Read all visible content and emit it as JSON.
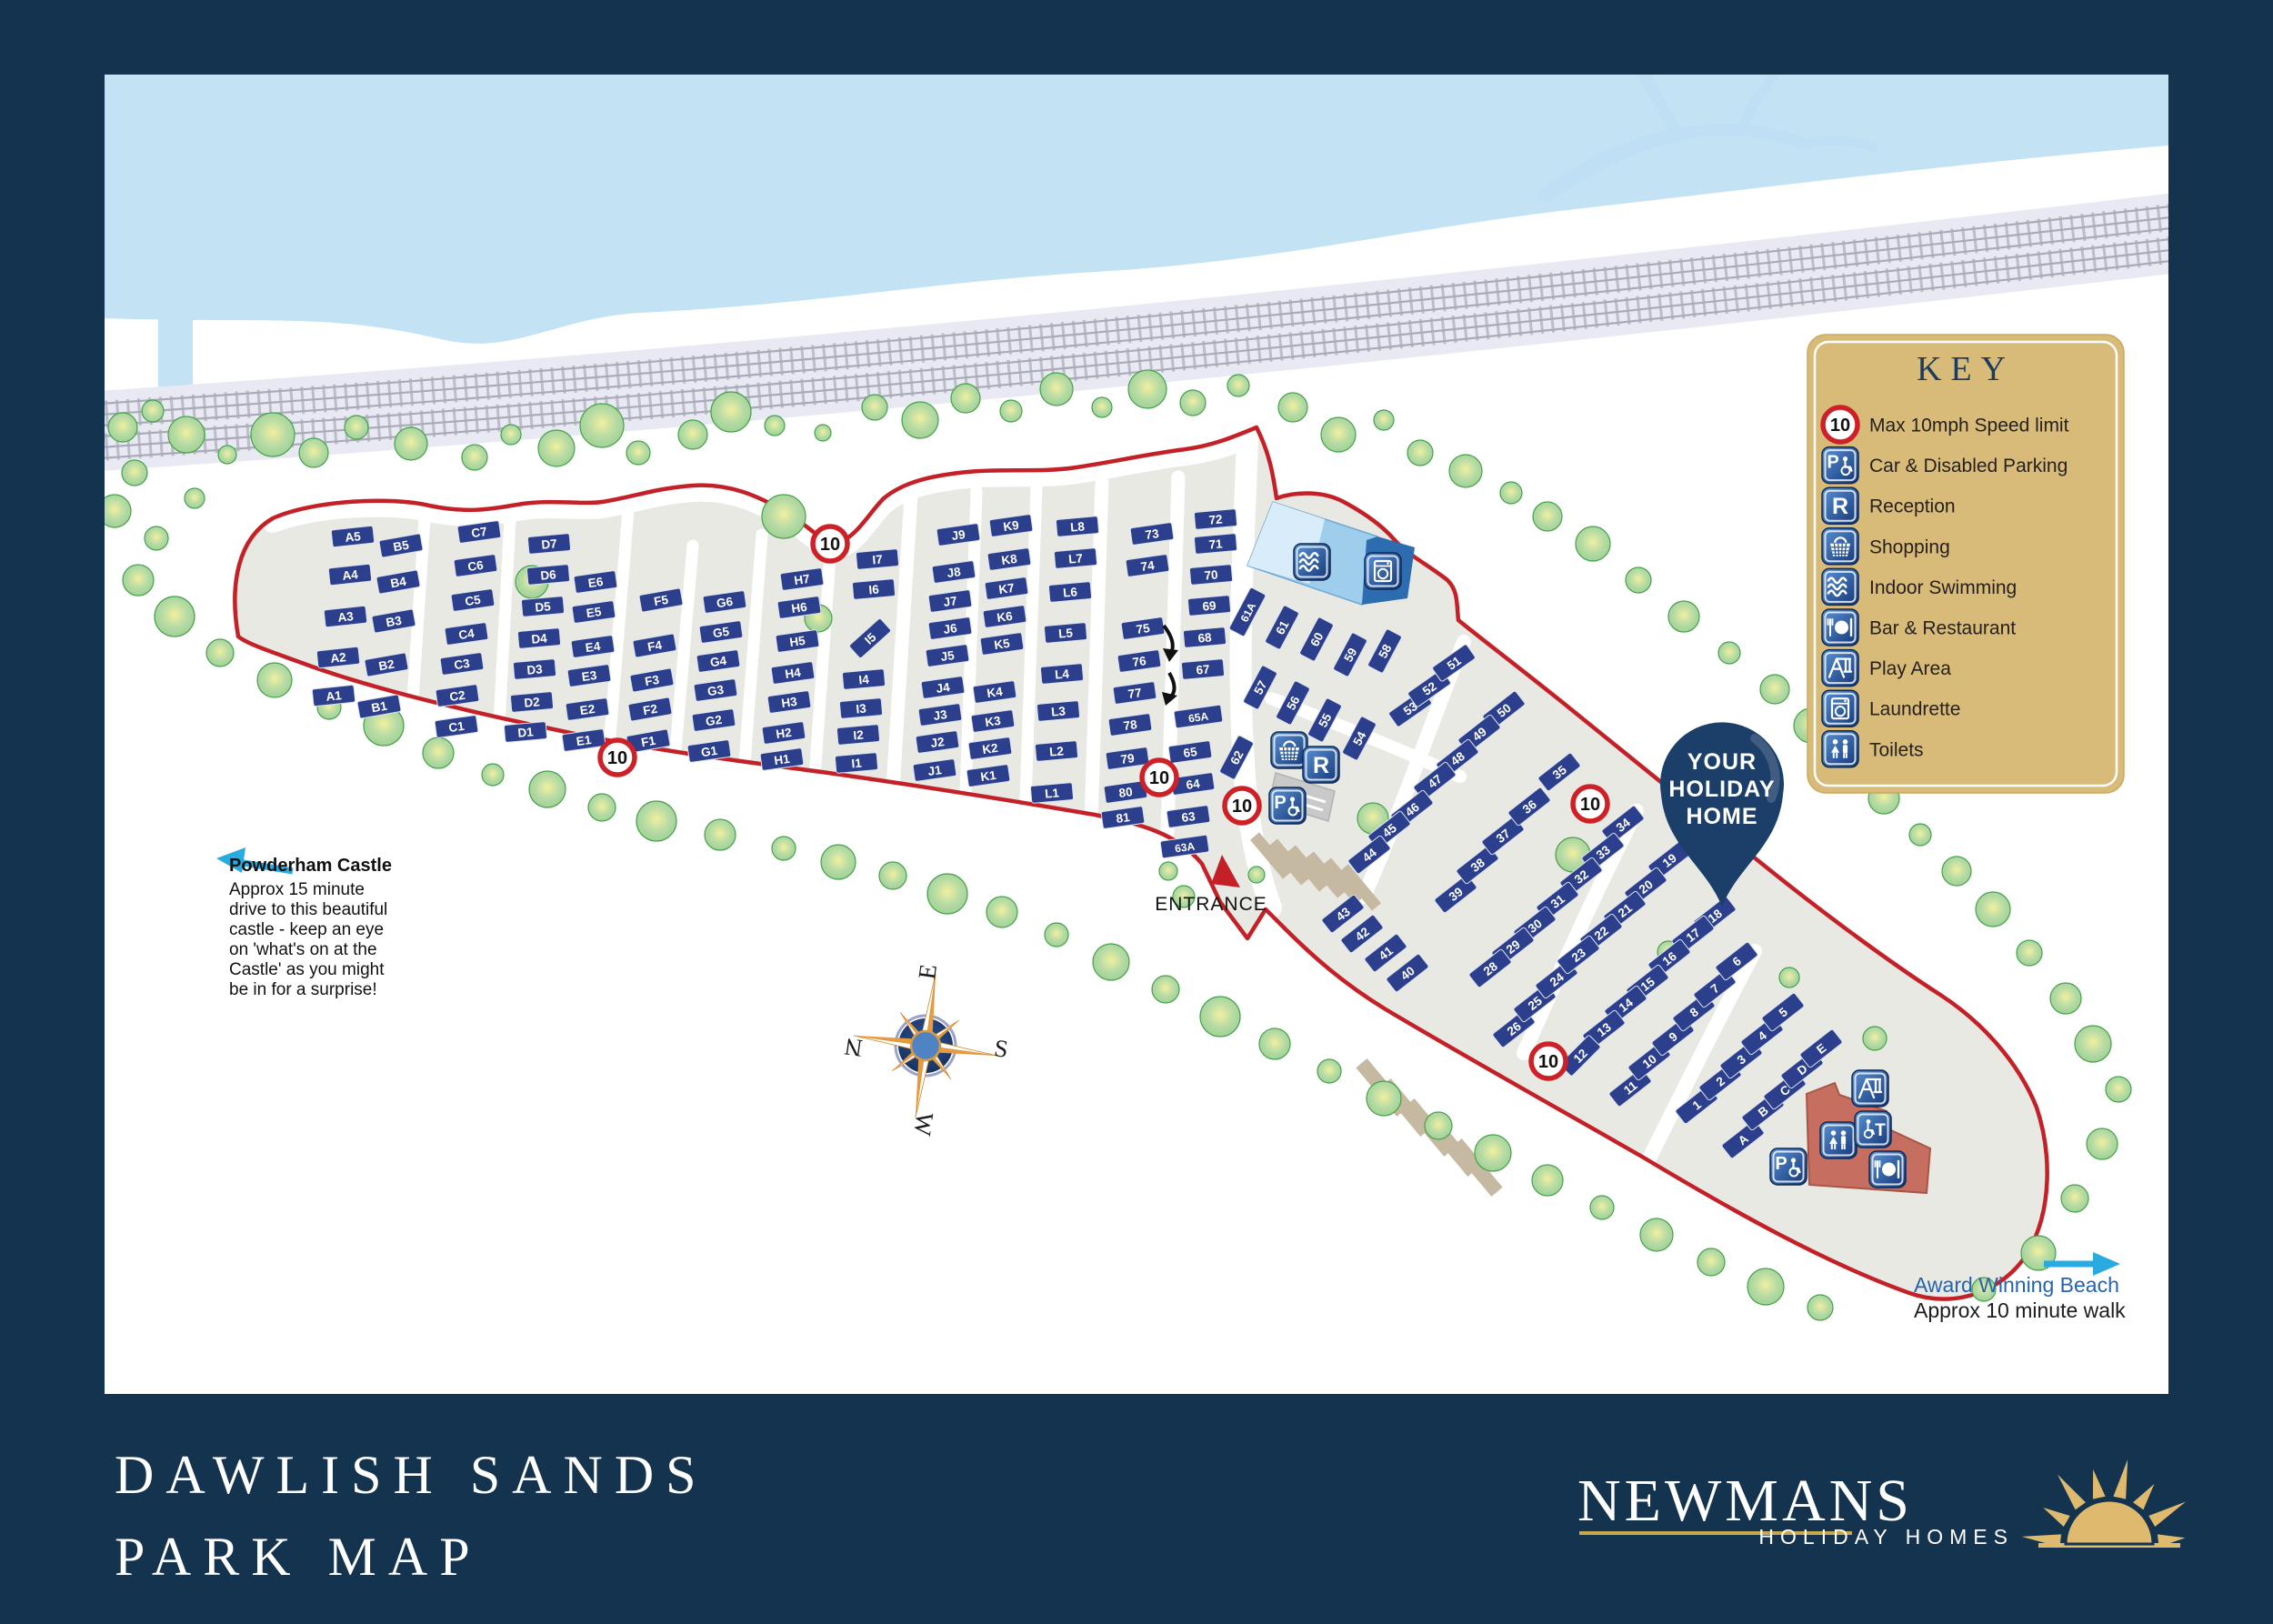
{
  "title": {
    "line1": "DAWLISH SANDS",
    "line2": "PARK MAP"
  },
  "brand": {
    "name": "NEWMANS",
    "tagline": "HOLIDAY HOMES"
  },
  "colors": {
    "border_navy": "#14334f",
    "plot_navy": "#2c3f8d",
    "boundary_red": "#c32127",
    "land_grey": "#e9e9e4",
    "water_blue": "#c3e2f4",
    "tree_green": "#aed7a2",
    "legend_gold": "#d8bb78",
    "icon_blue": "#1e4d9b",
    "pin_navy": "#1c3f69",
    "logo_gold": "#d9b96a",
    "arrow_blue": "#29abe2"
  },
  "legend": {
    "title": "KEY",
    "items": [
      {
        "type": "speed",
        "label": "Max 10mph Speed limit"
      },
      {
        "type": "parking",
        "label": "Car & Disabled Parking"
      },
      {
        "type": "reception",
        "label": "Reception"
      },
      {
        "type": "shopping",
        "label": "Shopping"
      },
      {
        "type": "swim",
        "label": "Indoor Swimming"
      },
      {
        "type": "bar",
        "label": "Bar & Restaurant"
      },
      {
        "type": "play",
        "label": "Play Area"
      },
      {
        "type": "laundrette",
        "label": "Laundrette"
      },
      {
        "type": "toilets",
        "label": "Toilets"
      }
    ]
  },
  "icon_glyphs": {
    "reception": "R",
    "parking": "P",
    "disabled": "T"
  },
  "annotations": {
    "entrance": "ENTRANCE",
    "pin": [
      "YOUR",
      "HOLIDAY",
      "HOME"
    ],
    "compass": {
      "n": "N",
      "e": "E",
      "s": "S",
      "w": "W"
    },
    "powderham": {
      "heading": "Powderham Castle",
      "lines": [
        "Approx 15 minute",
        "drive to this beautiful",
        "castle - keep an eye",
        "on 'what's on at the",
        "Castle' as you might",
        "be in for a surprise!"
      ]
    },
    "beach": {
      "line1": "Award Winning Beach",
      "line2": "Approx 10 minute walk"
    }
  },
  "map": {
    "speed_label": "10",
    "speed_signs": [
      [
        913,
        598
      ],
      [
        679,
        833
      ],
      [
        1275,
        855
      ],
      [
        1366,
        886
      ],
      [
        1749,
        884
      ],
      [
        1703,
        1167
      ]
    ],
    "facility_icons": [
      [
        "swim",
        1443,
        618
      ],
      [
        "laundrette",
        1521,
        628
      ],
      [
        "shopping",
        1418,
        825
      ],
      [
        "reception",
        1453,
        841
      ],
      [
        "parking",
        1416,
        886
      ],
      [
        "parking",
        1967,
        1283
      ],
      [
        "play",
        2057,
        1197
      ],
      [
        "toilets",
        2022,
        1254
      ],
      [
        "disabled",
        2060,
        1242
      ],
      [
        "bar",
        2076,
        1286
      ]
    ],
    "plots": [
      [
        "A5",
        388,
        590,
        -6
      ],
      [
        "A4",
        385,
        632,
        -6
      ],
      [
        "A3",
        380,
        678,
        -6
      ],
      [
        "A2",
        372,
        723,
        -6
      ],
      [
        "A1",
        367,
        765,
        -6
      ],
      [
        "B5",
        441,
        600,
        -10
      ],
      [
        "B4",
        438,
        640,
        -10
      ],
      [
        "B3",
        433,
        683,
        -10
      ],
      [
        "B2",
        425,
        731,
        -10
      ],
      [
        "B1",
        417,
        777,
        -10
      ],
      [
        "C7",
        527,
        585,
        -8
      ],
      [
        "C6",
        523,
        622,
        -8
      ],
      [
        "C5",
        520,
        660,
        -8
      ],
      [
        "C4",
        513,
        697,
        -8
      ],
      [
        "C3",
        508,
        730,
        -8
      ],
      [
        "C2",
        503,
        765,
        -8
      ],
      [
        "C1",
        502,
        799,
        -8
      ],
      [
        "D7",
        604,
        598,
        -5
      ],
      [
        "D6",
        603,
        632,
        -5
      ],
      [
        "D5",
        597,
        667,
        -5
      ],
      [
        "D4",
        593,
        702,
        -5
      ],
      [
        "D3",
        588,
        736,
        -5
      ],
      [
        "D2",
        585,
        772,
        -5
      ],
      [
        "D1",
        578,
        805,
        -5
      ],
      [
        "E6",
        655,
        640,
        -8
      ],
      [
        "E5",
        653,
        673,
        -8
      ],
      [
        "E4",
        652,
        711,
        -8
      ],
      [
        "E3",
        648,
        743,
        -8
      ],
      [
        "E2",
        646,
        780,
        -8
      ],
      [
        "E1",
        642,
        814,
        -8
      ],
      [
        "F5",
        727,
        660,
        -10
      ],
      [
        "F4",
        720,
        710,
        -10
      ],
      [
        "F3",
        717,
        748,
        -10
      ],
      [
        "F2",
        715,
        780,
        -10
      ],
      [
        "F1",
        713,
        815,
        -10
      ],
      [
        "G6",
        797,
        662,
        -8
      ],
      [
        "G5",
        793,
        695,
        -8
      ],
      [
        "G4",
        790,
        727,
        -8
      ],
      [
        "G3",
        787,
        759,
        -8
      ],
      [
        "G2",
        785,
        792,
        -8
      ],
      [
        "G1",
        780,
        826,
        -8
      ],
      [
        "H7",
        882,
        637,
        -8
      ],
      [
        "H6",
        879,
        668,
        -8
      ],
      [
        "H5",
        877,
        705,
        -8
      ],
      [
        "H4",
        872,
        740,
        -8
      ],
      [
        "H3",
        868,
        772,
        -8
      ],
      [
        "H2",
        862,
        806,
        -8
      ],
      [
        "H1",
        860,
        835,
        -8
      ],
      [
        "I7",
        965,
        615,
        -5
      ],
      [
        "I6",
        961,
        648,
        -5
      ],
      [
        "I5",
        957,
        702,
        -42
      ],
      [
        "I4",
        950,
        747,
        -5
      ],
      [
        "I3",
        947,
        779,
        -5
      ],
      [
        "I2",
        944,
        808,
        -5
      ],
      [
        "I1",
        942,
        839,
        -5
      ],
      [
        "J9",
        1054,
        588,
        -8
      ],
      [
        "J8",
        1049,
        629,
        -8
      ],
      [
        "J7",
        1045,
        661,
        -8
      ],
      [
        "J6",
        1045,
        691,
        -8
      ],
      [
        "J5",
        1042,
        721,
        -8
      ],
      [
        "J4",
        1037,
        756,
        -8
      ],
      [
        "J3",
        1034,
        786,
        -8
      ],
      [
        "J2",
        1031,
        816,
        -8
      ],
      [
        "J1",
        1028,
        847,
        -8
      ],
      [
        "K9",
        1112,
        578,
        -8
      ],
      [
        "K8",
        1110,
        615,
        -8
      ],
      [
        "K7",
        1107,
        647,
        -8
      ],
      [
        "K6",
        1105,
        678,
        -8
      ],
      [
        "K5",
        1102,
        708,
        -8
      ],
      [
        "K4",
        1094,
        761,
        -8
      ],
      [
        "K3",
        1092,
        793,
        -8
      ],
      [
        "K2",
        1089,
        823,
        -8
      ],
      [
        "K1",
        1087,
        853,
        -8
      ],
      [
        "L8",
        1185,
        579,
        -5
      ],
      [
        "L7",
        1183,
        614,
        -5
      ],
      [
        "L6",
        1177,
        651,
        -5
      ],
      [
        "L5",
        1172,
        696,
        -5
      ],
      [
        "L4",
        1168,
        741,
        -5
      ],
      [
        "L3",
        1164,
        782,
        -5
      ],
      [
        "L2",
        1162,
        826,
        -5
      ],
      [
        "L1",
        1157,
        872,
        -5
      ],
      [
        "73",
        1267,
        587,
        -8
      ],
      [
        "74",
        1262,
        622,
        -8
      ],
      [
        "75",
        1257,
        691,
        -8
      ],
      [
        "76",
        1253,
        727,
        -8
      ],
      [
        "77",
        1248,
        762,
        -8
      ],
      [
        "78",
        1243,
        797,
        -8
      ],
      [
        "79",
        1240,
        834,
        -8
      ],
      [
        "80",
        1238,
        871,
        -8
      ],
      [
        "81",
        1235,
        899,
        -8
      ],
      [
        "72",
        1337,
        571,
        -5
      ],
      [
        "71",
        1337,
        598,
        -5
      ],
      [
        "70",
        1332,
        632,
        -5
      ],
      [
        "69",
        1330,
        666,
        -5
      ],
      [
        "68",
        1325,
        701,
        -5
      ],
      [
        "67",
        1323,
        736,
        -5
      ],
      [
        "65A",
        1318,
        788,
        -8
      ],
      [
        "65",
        1309,
        827,
        -8
      ],
      [
        "64",
        1312,
        862,
        -8
      ],
      [
        "63",
        1307,
        898,
        -8
      ],
      [
        "63A",
        1303,
        931,
        -8
      ],
      [
        "62",
        1360,
        833,
        -62
      ],
      [
        "61A",
        1372,
        673,
        -62
      ],
      [
        "61",
        1410,
        690,
        -62
      ],
      [
        "60",
        1448,
        703,
        -62
      ],
      [
        "59",
        1485,
        720,
        -62
      ],
      [
        "58",
        1523,
        716,
        -62
      ],
      [
        "57",
        1386,
        756,
        -62
      ],
      [
        "56",
        1422,
        773,
        -62
      ],
      [
        "55",
        1457,
        792,
        -62
      ],
      [
        "54",
        1495,
        812,
        -62
      ],
      [
        "53",
        1551,
        779,
        -35
      ],
      [
        "52",
        1572,
        757,
        -35
      ],
      [
        "51",
        1599,
        729,
        -35
      ],
      [
        "50",
        1654,
        781,
        -38
      ],
      [
        "49",
        1627,
        807,
        -38
      ],
      [
        "48",
        1603,
        834,
        -38
      ],
      [
        "47",
        1578,
        859,
        -38
      ],
      [
        "46",
        1553,
        890,
        -38
      ],
      [
        "45",
        1528,
        913,
        -38
      ],
      [
        "44",
        1506,
        940,
        -38
      ],
      [
        "43",
        1477,
        1005,
        -38
      ],
      [
        "42",
        1498,
        1027,
        -38
      ],
      [
        "41",
        1524,
        1048,
        -38
      ],
      [
        "40",
        1548,
        1070,
        -38
      ],
      [
        "39",
        1601,
        983,
        -38
      ],
      [
        "38",
        1625,
        951,
        -38
      ],
      [
        "37",
        1653,
        919,
        -38
      ],
      [
        "36",
        1682,
        887,
        -38
      ],
      [
        "35",
        1715,
        849,
        -38
      ],
      [
        "34",
        1785,
        907,
        -38
      ],
      [
        "33",
        1763,
        937,
        -38
      ],
      [
        "32",
        1739,
        964,
        -38
      ],
      [
        "31",
        1713,
        991,
        -38
      ],
      [
        "30",
        1688,
        1018,
        -38
      ],
      [
        "29",
        1664,
        1041,
        -38
      ],
      [
        "28",
        1639,
        1065,
        -38
      ],
      [
        "26",
        1665,
        1131,
        -38
      ],
      [
        "25",
        1688,
        1103,
        -38
      ],
      [
        "24",
        1712,
        1077,
        -38
      ],
      [
        "19",
        1836,
        946,
        -38
      ],
      [
        "20",
        1810,
        975,
        -38
      ],
      [
        "21",
        1787,
        1001,
        -38
      ],
      [
        "22",
        1761,
        1026,
        -38
      ],
      [
        "23",
        1736,
        1050,
        -38
      ],
      [
        "18",
        1886,
        1007,
        -38
      ],
      [
        "17",
        1862,
        1028,
        -38
      ],
      [
        "16",
        1836,
        1054,
        -38
      ],
      [
        "15",
        1812,
        1082,
        -38
      ],
      [
        "14",
        1788,
        1105,
        -38
      ],
      [
        "13",
        1764,
        1132,
        -38
      ],
      [
        "12",
        1738,
        1161,
        -45
      ],
      [
        "11",
        1793,
        1196,
        -38
      ],
      [
        "10",
        1814,
        1167,
        -38
      ],
      [
        "9",
        1840,
        1140,
        -38
      ],
      [
        "8",
        1863,
        1113,
        -38
      ],
      [
        "7",
        1886,
        1087,
        -38
      ],
      [
        "6",
        1910,
        1057,
        -38
      ],
      [
        "1",
        1866,
        1215,
        -38
      ],
      [
        "2",
        1892,
        1189,
        -38
      ],
      [
        "3",
        1915,
        1165,
        -38
      ],
      [
        "4",
        1938,
        1139,
        -38
      ],
      [
        "5",
        1961,
        1113,
        -38
      ],
      [
        "A",
        1917,
        1253,
        -38
      ],
      [
        "B",
        1939,
        1222,
        -38
      ],
      [
        "C",
        1963,
        1199,
        -38
      ],
      [
        "D",
        1982,
        1176,
        -38
      ],
      [
        "E",
        2003,
        1153,
        -38
      ]
    ],
    "trees": [
      [
        135,
        470,
        16
      ],
      [
        168,
        452,
        12
      ],
      [
        205,
        478,
        20
      ],
      [
        148,
        520,
        14
      ],
      [
        126,
        562,
        18
      ],
      [
        172,
        592,
        13
      ],
      [
        214,
        548,
        11
      ],
      [
        250,
        500,
        10
      ],
      [
        300,
        478,
        24
      ],
      [
        345,
        498,
        16
      ],
      [
        392,
        470,
        13
      ],
      [
        452,
        488,
        18
      ],
      [
        522,
        503,
        14
      ],
      [
        562,
        478,
        11
      ],
      [
        612,
        493,
        20
      ],
      [
        662,
        468,
        24
      ],
      [
        702,
        498,
        13
      ],
      [
        762,
        478,
        16
      ],
      [
        804,
        453,
        22
      ],
      [
        852,
        468,
        11
      ],
      [
        905,
        476,
        9
      ],
      [
        962,
        448,
        14
      ],
      [
        1012,
        462,
        20
      ],
      [
        1062,
        438,
        16
      ],
      [
        1112,
        452,
        12
      ],
      [
        1162,
        428,
        18
      ],
      [
        1212,
        448,
        11
      ],
      [
        1262,
        428,
        21
      ],
      [
        1312,
        443,
        14
      ],
      [
        1362,
        424,
        12
      ],
      [
        1422,
        448,
        16
      ],
      [
        1472,
        478,
        19
      ],
      [
        1522,
        462,
        11
      ],
      [
        1562,
        498,
        14
      ],
      [
        1612,
        518,
        18
      ],
      [
        1662,
        542,
        12
      ],
      [
        1702,
        568,
        16
      ],
      [
        1752,
        598,
        19
      ],
      [
        1802,
        638,
        14
      ],
      [
        1852,
        678,
        17
      ],
      [
        1902,
        718,
        12
      ],
      [
        1952,
        758,
        16
      ],
      [
        1992,
        798,
        19
      ],
      [
        2032,
        838,
        14
      ],
      [
        2072,
        878,
        17
      ],
      [
        2112,
        918,
        12
      ],
      [
        2152,
        958,
        16
      ],
      [
        2192,
        1000,
        19
      ],
      [
        2232,
        1048,
        14
      ],
      [
        2272,
        1098,
        17
      ],
      [
        2302,
        1148,
        20
      ],
      [
        2330,
        1198,
        14
      ],
      [
        2312,
        1258,
        17
      ],
      [
        2282,
        1318,
        15
      ],
      [
        2242,
        1378,
        19
      ],
      [
        2182,
        1418,
        13
      ],
      [
        152,
        638,
        17
      ],
      [
        192,
        678,
        22
      ],
      [
        242,
        718,
        15
      ],
      [
        302,
        748,
        19
      ],
      [
        362,
        778,
        13
      ],
      [
        422,
        798,
        22
      ],
      [
        482,
        828,
        17
      ],
      [
        542,
        852,
        12
      ],
      [
        602,
        868,
        20
      ],
      [
        662,
        888,
        15
      ],
      [
        722,
        903,
        22
      ],
      [
        792,
        918,
        17
      ],
      [
        862,
        933,
        13
      ],
      [
        922,
        948,
        19
      ],
      [
        982,
        963,
        15
      ],
      [
        1042,
        983,
        22
      ],
      [
        1102,
        1003,
        17
      ],
      [
        1162,
        1028,
        13
      ],
      [
        1222,
        1058,
        20
      ],
      [
        1282,
        1088,
        15
      ],
      [
        1342,
        1118,
        22
      ],
      [
        1402,
        1148,
        17
      ],
      [
        1462,
        1178,
        13
      ],
      [
        1522,
        1208,
        19
      ],
      [
        1582,
        1238,
        15
      ],
      [
        1642,
        1268,
        20
      ],
      [
        1702,
        1298,
        17
      ],
      [
        1762,
        1328,
        13
      ],
      [
        1822,
        1358,
        18
      ],
      [
        1882,
        1388,
        15
      ],
      [
        1942,
        1415,
        20
      ],
      [
        2002,
        1438,
        14
      ],
      [
        585,
        640,
        18
      ],
      [
        862,
        568,
        24
      ],
      [
        900,
        680,
        15
      ],
      [
        1510,
        900,
        17
      ],
      [
        1730,
        940,
        19
      ],
      [
        1835,
        1047,
        12
      ],
      [
        1285,
        958,
        10
      ],
      [
        1382,
        962,
        9
      ],
      [
        1302,
        986,
        12
      ],
      [
        2062,
        1142,
        13
      ],
      [
        1968,
        1075,
        11
      ]
    ]
  }
}
